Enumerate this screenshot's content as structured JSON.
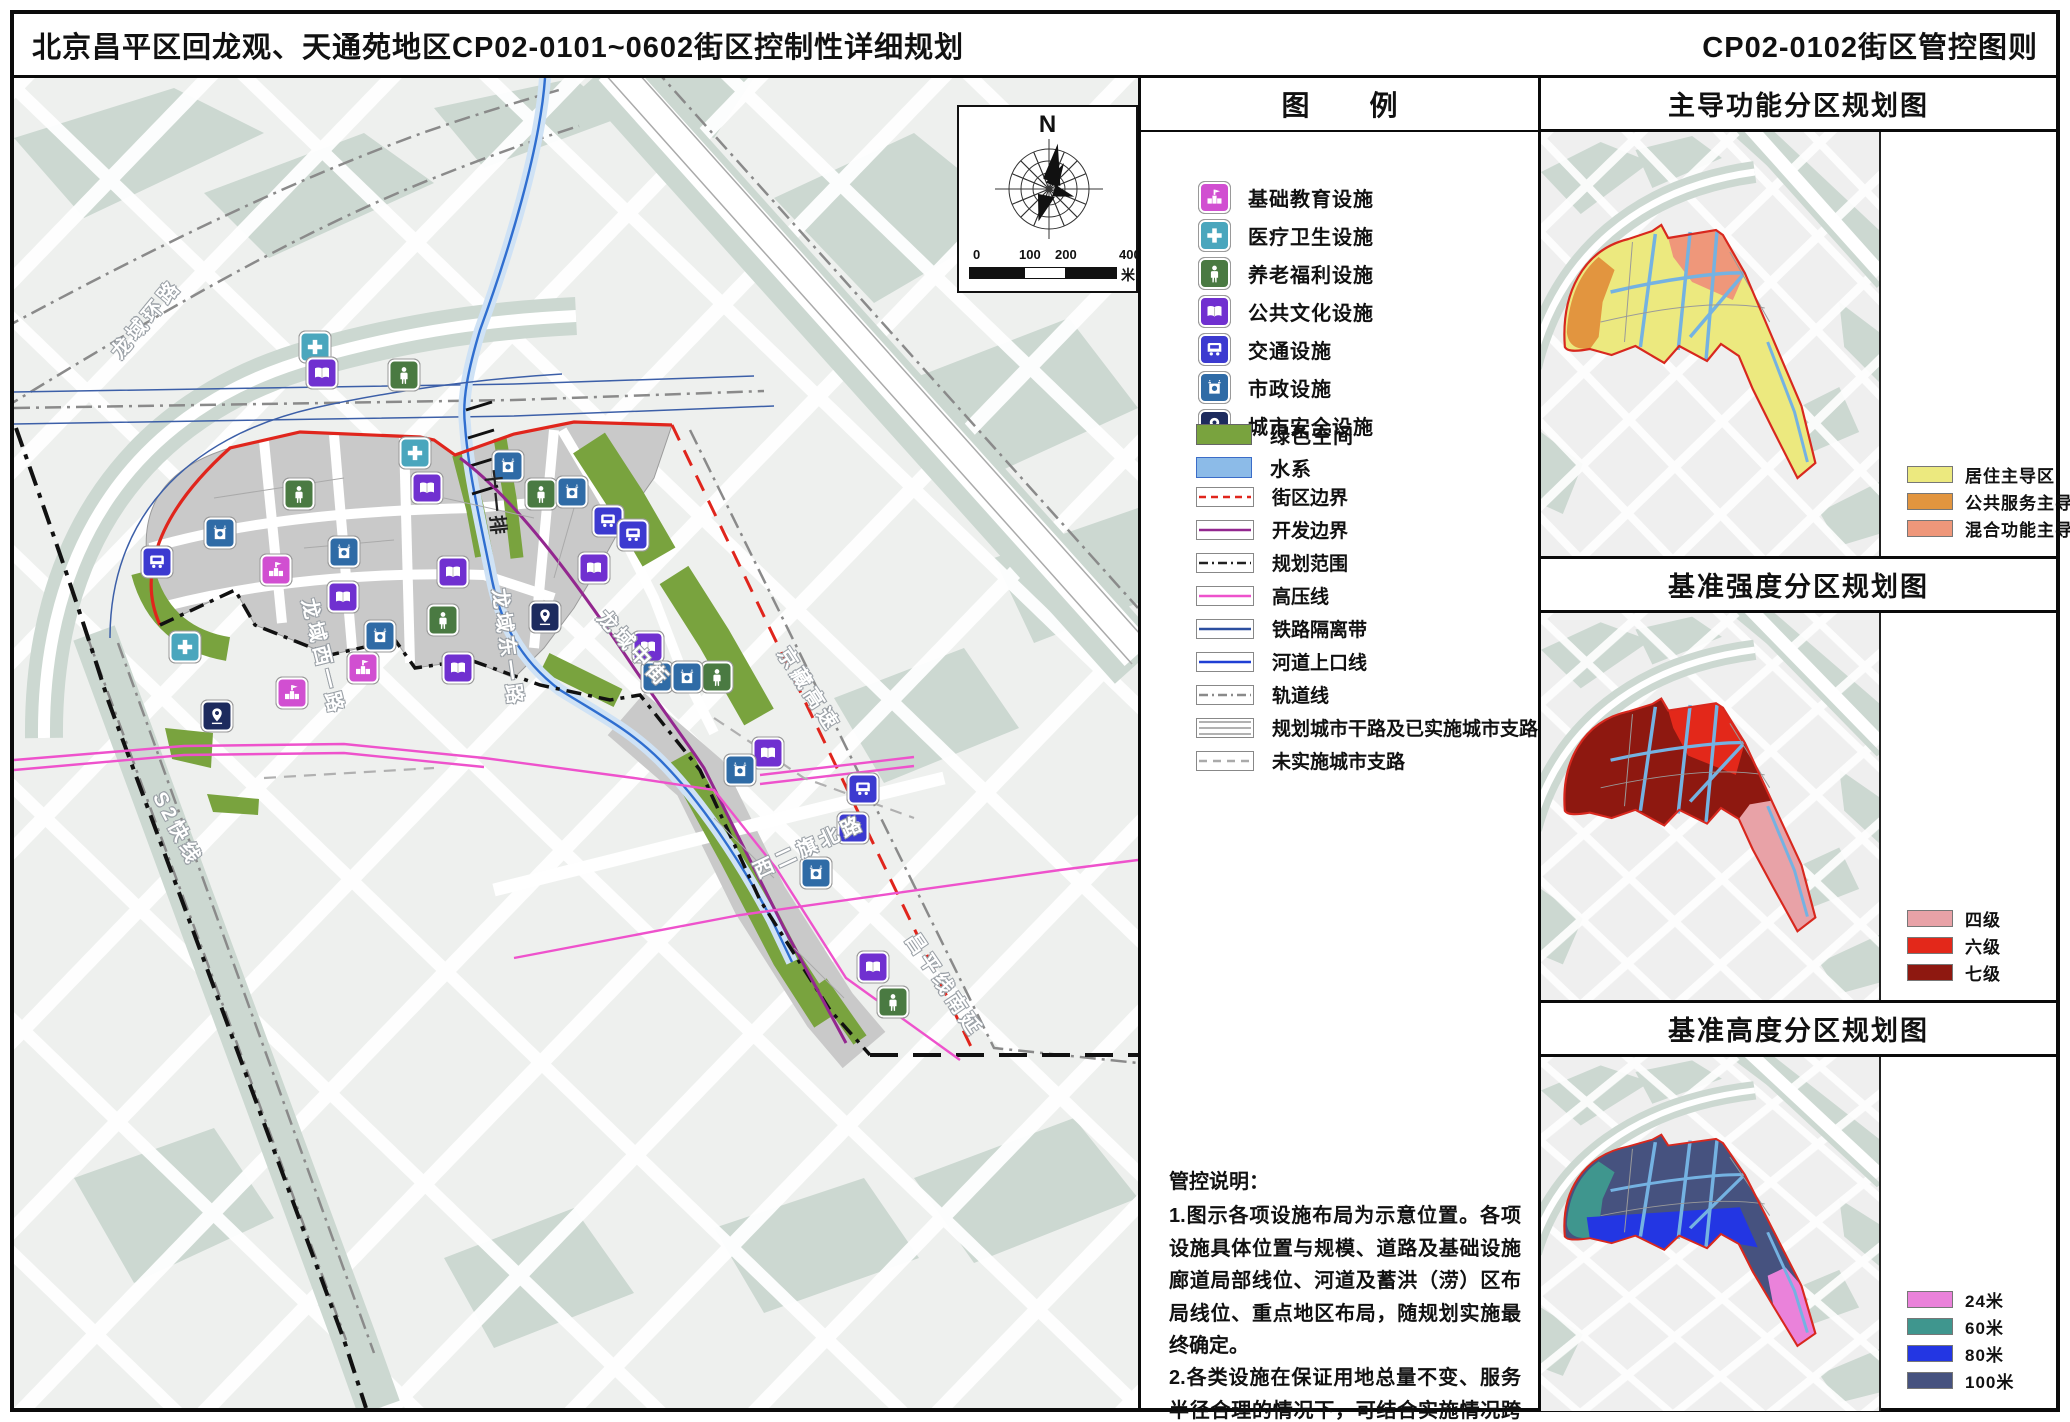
{
  "header": {
    "title_left": "北京昌平区回龙观、天通苑地区CP02-0101~0602街区控制性详细规划",
    "title_right": "CP02-0102街区管控图则"
  },
  "compass": {
    "north": "N",
    "scale_ticks": [
      "0",
      "100",
      "200",
      "400"
    ],
    "scale_unit": "米"
  },
  "legend": {
    "title_chars": [
      "图",
      "例"
    ],
    "facilities": [
      {
        "id": "school",
        "label": "基础教育设施",
        "color": "#d14fd1"
      },
      {
        "id": "medical",
        "label": "医疗卫生设施",
        "color": "#4aa6bd"
      },
      {
        "id": "elderly",
        "label": "养老福利设施",
        "color": "#4a7a42"
      },
      {
        "id": "culture",
        "label": "公共文化设施",
        "color": "#7030d0"
      },
      {
        "id": "transit",
        "label": "交通设施",
        "color": "#3c3ad0"
      },
      {
        "id": "municipal",
        "label": "市政设施",
        "color": "#2f6ba6"
      },
      {
        "id": "safety",
        "label": "城市安全设施",
        "color": "#1d2b5e"
      }
    ],
    "areas": [
      {
        "label": "绿色空间",
        "fill": "#79a33e",
        "border": "#666666"
      },
      {
        "label": "水系",
        "fill": "#8cbbe8",
        "border": "#3b6cc8"
      }
    ],
    "lines": [
      {
        "label": "街区边界",
        "style": "dashed",
        "color": "#e0251c"
      },
      {
        "label": "开发边界",
        "style": "solid",
        "color": "#93278f"
      },
      {
        "label": "规划范围",
        "style": "dashdot",
        "color": "#222222"
      },
      {
        "label": "高压线",
        "style": "solid",
        "color": "#ee52cc"
      },
      {
        "label": "铁路隔离带",
        "style": "solid",
        "color": "#2b4fa0"
      },
      {
        "label": "河道上口线",
        "style": "solid",
        "color": "#1f3fd4"
      },
      {
        "label": "轨道线",
        "style": "dashdot",
        "color": "#8a8a8a"
      },
      {
        "label": "规划城市干路及已实施城市支路",
        "style": "triple",
        "color": "#999999"
      },
      {
        "label": "未实施城市支路",
        "style": "graydash",
        "color": "#aaaaaa"
      }
    ]
  },
  "notes": {
    "title": "管控说明：",
    "paragraphs": [
      "1.图示各项设施布局为示意位置。各项设施具体位置与规模、道路及基础设施廊道局部线位、河道及蓄洪（涝）区布局线位、重点地区布局，随规划实施最终确定。",
      "2.各类设施在保证用地总量不变、服务半径合理的情况下，可结合实施情况跨街区统筹。"
    ]
  },
  "map": {
    "road_labels": [
      {
        "text": "龙域环路",
        "x": 100,
        "y": 262,
        "rot": -50,
        "dark": false
      },
      {
        "text": "龙域西一路",
        "x": 296,
        "y": 506,
        "rot": 76,
        "dark": false
      },
      {
        "text": "龙域东一路",
        "x": 487,
        "y": 496,
        "rot": 82,
        "dark": false
      },
      {
        "text": "龙域中街",
        "x": 588,
        "y": 520,
        "rot": 47,
        "dark": false
      },
      {
        "text": "十一排",
        "x": 479,
        "y": 378,
        "rot": 84,
        "dark": true
      },
      {
        "text": "京藏高速",
        "x": 770,
        "y": 556,
        "rot": 57,
        "dark": false
      },
      {
        "text": "S2快线",
        "x": 146,
        "y": 700,
        "rot": 62,
        "dark": false
      },
      {
        "text": "西二旗北路",
        "x": 740,
        "y": 778,
        "rot": -25,
        "dark": false
      },
      {
        "text": "昌平线南延",
        "x": 898,
        "y": 842,
        "rot": 56,
        "dark": false
      }
    ],
    "icons": [
      {
        "type": "medical",
        "x": 301,
        "y": 269
      },
      {
        "type": "medical",
        "x": 401,
        "y": 375
      },
      {
        "type": "medical",
        "x": 171,
        "y": 569
      },
      {
        "type": "school",
        "x": 262,
        "y": 492
      },
      {
        "type": "school",
        "x": 349,
        "y": 590
      },
      {
        "type": "school",
        "x": 278,
        "y": 615
      },
      {
        "type": "elderly",
        "x": 390,
        "y": 297
      },
      {
        "type": "elderly",
        "x": 285,
        "y": 416
      },
      {
        "type": "elderly",
        "x": 429,
        "y": 542
      },
      {
        "type": "elderly",
        "x": 527,
        "y": 416
      },
      {
        "type": "elderly",
        "x": 703,
        "y": 599
      },
      {
        "type": "elderly",
        "x": 879,
        "y": 924
      },
      {
        "type": "culture",
        "x": 308,
        "y": 295
      },
      {
        "type": "culture",
        "x": 413,
        "y": 410
      },
      {
        "type": "culture",
        "x": 329,
        "y": 519
      },
      {
        "type": "culture",
        "x": 439,
        "y": 494
      },
      {
        "type": "culture",
        "x": 444,
        "y": 590
      },
      {
        "type": "culture",
        "x": 580,
        "y": 490
      },
      {
        "type": "culture",
        "x": 634,
        "y": 569
      },
      {
        "type": "culture",
        "x": 754,
        "y": 675
      },
      {
        "type": "culture",
        "x": 859,
        "y": 889
      },
      {
        "type": "transit",
        "x": 143,
        "y": 484
      },
      {
        "type": "transit",
        "x": 594,
        "y": 443
      },
      {
        "type": "transit",
        "x": 619,
        "y": 457
      },
      {
        "type": "transit",
        "x": 849,
        "y": 711
      },
      {
        "type": "transit",
        "x": 839,
        "y": 750
      },
      {
        "type": "municipal",
        "x": 206,
        "y": 455
      },
      {
        "type": "municipal",
        "x": 330,
        "y": 474
      },
      {
        "type": "municipal",
        "x": 366,
        "y": 558
      },
      {
        "type": "municipal",
        "x": 494,
        "y": 388
      },
      {
        "type": "municipal",
        "x": 558,
        "y": 414
      },
      {
        "type": "municipal",
        "x": 643,
        "y": 599
      },
      {
        "type": "municipal",
        "x": 673,
        "y": 599
      },
      {
        "type": "municipal",
        "x": 802,
        "y": 795
      },
      {
        "type": "municipal",
        "x": 726,
        "y": 692
      },
      {
        "type": "safety",
        "x": 531,
        "y": 539
      },
      {
        "type": "safety",
        "x": 203,
        "y": 638
      }
    ]
  },
  "panels": [
    {
      "title": "主导功能分区规划图",
      "legend": [
        {
          "label": "居住主导区",
          "fill": "#ece97f"
        },
        {
          "label": "公共服务主导区",
          "fill": "#e2953f"
        },
        {
          "label": "混合功能主导区",
          "fill": "#ef977a"
        }
      ]
    },
    {
      "title": "基准强度分区规划图",
      "legend": [
        {
          "label": "四级",
          "fill": "#e8a2a7"
        },
        {
          "label": "六级",
          "fill": "#e3281a"
        },
        {
          "label": "七级",
          "fill": "#8e1810"
        }
      ]
    },
    {
      "title": "基准高度分区规划图",
      "legend": [
        {
          "label": "24米",
          "fill": "#ea82da"
        },
        {
          "label": "60米",
          "fill": "#3f968e"
        },
        {
          "label": "80米",
          "fill": "#2336e3"
        },
        {
          "label": "100米",
          "fill": "#46527f"
        }
      ]
    }
  ]
}
